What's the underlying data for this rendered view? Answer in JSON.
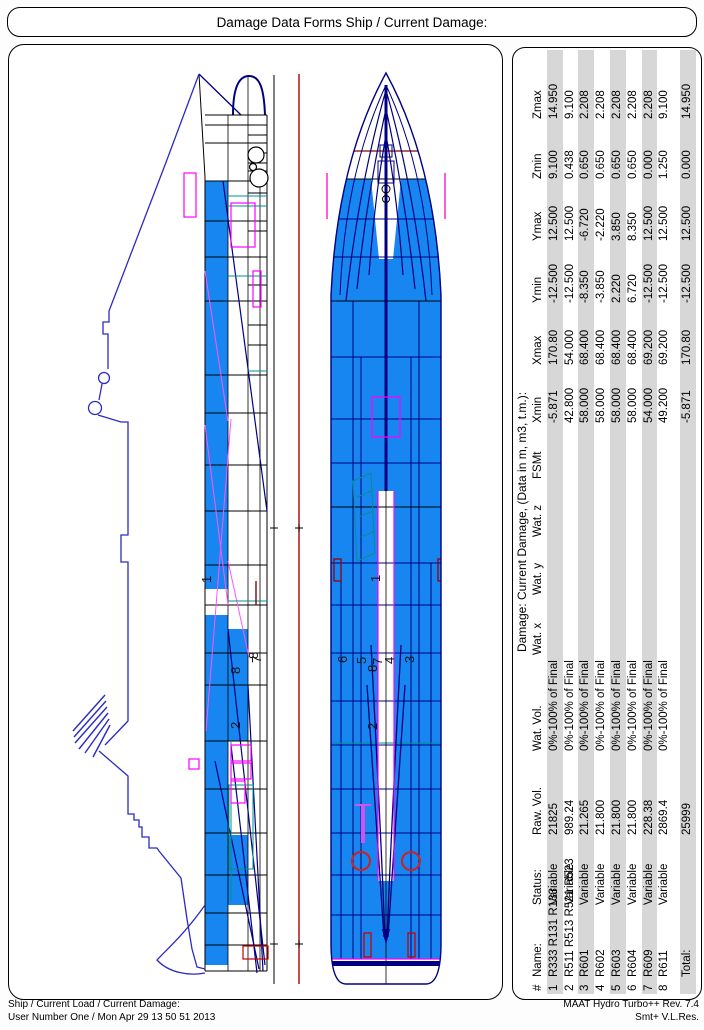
{
  "title_bar": {
    "text": "Damage Data Forms Ship / Current Damage:"
  },
  "footer": {
    "left_line1": "Ship / Current Load / Current Damage:",
    "left_line2": "User Number One / Mon Apr 29 13 50 51 2013",
    "right_line1": "MAAT Hydro Turbo++ Rev. 7.4",
    "right_line2": "Smt+ V.L.Res."
  },
  "damage_table": {
    "title": "Damage: Current Damage, (Data in m, m3, t.m.):",
    "columns": [
      "#",
      "Name:",
      "Status:",
      "Raw. Vol.",
      "Wat. Vol.",
      "Wat. x",
      "Wat. y",
      "Wat. z",
      "FSMt",
      "Xmin",
      "Xmax",
      "Ymin",
      "Ymax",
      "Zmin",
      "Zmax"
    ],
    "rows": [
      [
        "1",
        "R333 R131 R133",
        "Variable",
        "21825",
        "0%-100% of Final",
        "",
        "",
        "",
        "",
        "-5.871",
        "170.80",
        "-12.500",
        "12.500",
        "9.100",
        "14.950"
      ],
      [
        "2",
        "R511 R513 R521 R523",
        "Variable",
        "989.24",
        "0%-100% of Final",
        "",
        "",
        "",
        "",
        "42.800",
        "54.000",
        "-12.500",
        "12.500",
        "0.438",
        "9.100"
      ],
      [
        "3",
        "R601",
        "Variable",
        "21.265",
        "0%-100% of Final",
        "",
        "",
        "",
        "",
        "58.000",
        "68.400",
        "-8.350",
        "-6.720",
        "0.650",
        "2.208"
      ],
      [
        "4",
        "R602",
        "Variable",
        "21.800",
        "0%-100% of Final",
        "",
        "",
        "",
        "",
        "58.000",
        "68.400",
        "-3.850",
        "-2.220",
        "0.650",
        "2.208"
      ],
      [
        "5",
        "R603",
        "Variable",
        "21.800",
        "0%-100% of Final",
        "",
        "",
        "",
        "",
        "58.000",
        "68.400",
        "2.220",
        "3.850",
        "0.650",
        "2.208"
      ],
      [
        "6",
        "R604",
        "Variable",
        "21.800",
        "0%-100% of Final",
        "",
        "",
        "",
        "",
        "58.000",
        "68.400",
        "6.720",
        "8.350",
        "0.650",
        "2.208"
      ],
      [
        "7",
        "R609",
        "Variable",
        "228.38",
        "0%-100% of Final",
        "",
        "",
        "",
        "",
        "54.000",
        "69.200",
        "-12.500",
        "12.500",
        "0.000",
        "2.208"
      ],
      [
        "8",
        "R611",
        "Variable",
        "2869.4",
        "0%-100% of Final",
        "",
        "",
        "",
        "",
        "49.200",
        "69.200",
        "-12.500",
        "12.500",
        "1.250",
        "9.100"
      ]
    ],
    "total_row": [
      "",
      "Total:",
      "",
      "25999",
      "",
      "",
      "",
      "",
      "",
      "-5.871",
      "170.80",
      "-12.500",
      "12.500",
      "0.000",
      "14.950"
    ],
    "stripe_color": "#d7d7d7"
  },
  "drawing": {
    "profile_labels": [
      {
        "text": "1",
        "x": 202,
        "y": 538
      },
      {
        "text": "8",
        "x": 231,
        "y": 629
      },
      {
        "text": "7",
        "x": 252,
        "y": 618
      },
      {
        "text": "8",
        "x": 249,
        "y": 614
      },
      {
        "text": "2",
        "x": 231,
        "y": 684
      }
    ],
    "plan_labels": [
      {
        "text": "1",
        "x": 371,
        "y": 537
      },
      {
        "text": "6",
        "x": 338,
        "y": 618
      },
      {
        "text": "5",
        "x": 357,
        "y": 619
      },
      {
        "text": "8",
        "x": 368,
        "y": 627
      },
      {
        "text": "7",
        "x": 373,
        "y": 620
      },
      {
        "text": "4",
        "x": 385,
        "y": 619
      },
      {
        "text": "3",
        "x": 405,
        "y": 618
      },
      {
        "text": "2",
        "x": 368,
        "y": 685
      }
    ],
    "colors": {
      "compartment_fill_blue": "#1786f0",
      "outline_navy": "#000080",
      "superstructure_blue": "#2b2bc0",
      "accent_magenta": "#ff00ff",
      "accent_pink": "#ff55ff",
      "reference_red": "#b00000",
      "detail_dark_red": "#8b0000",
      "accent_teal": "#009090",
      "table_stripe_gray": "#d7d7d7"
    }
  }
}
